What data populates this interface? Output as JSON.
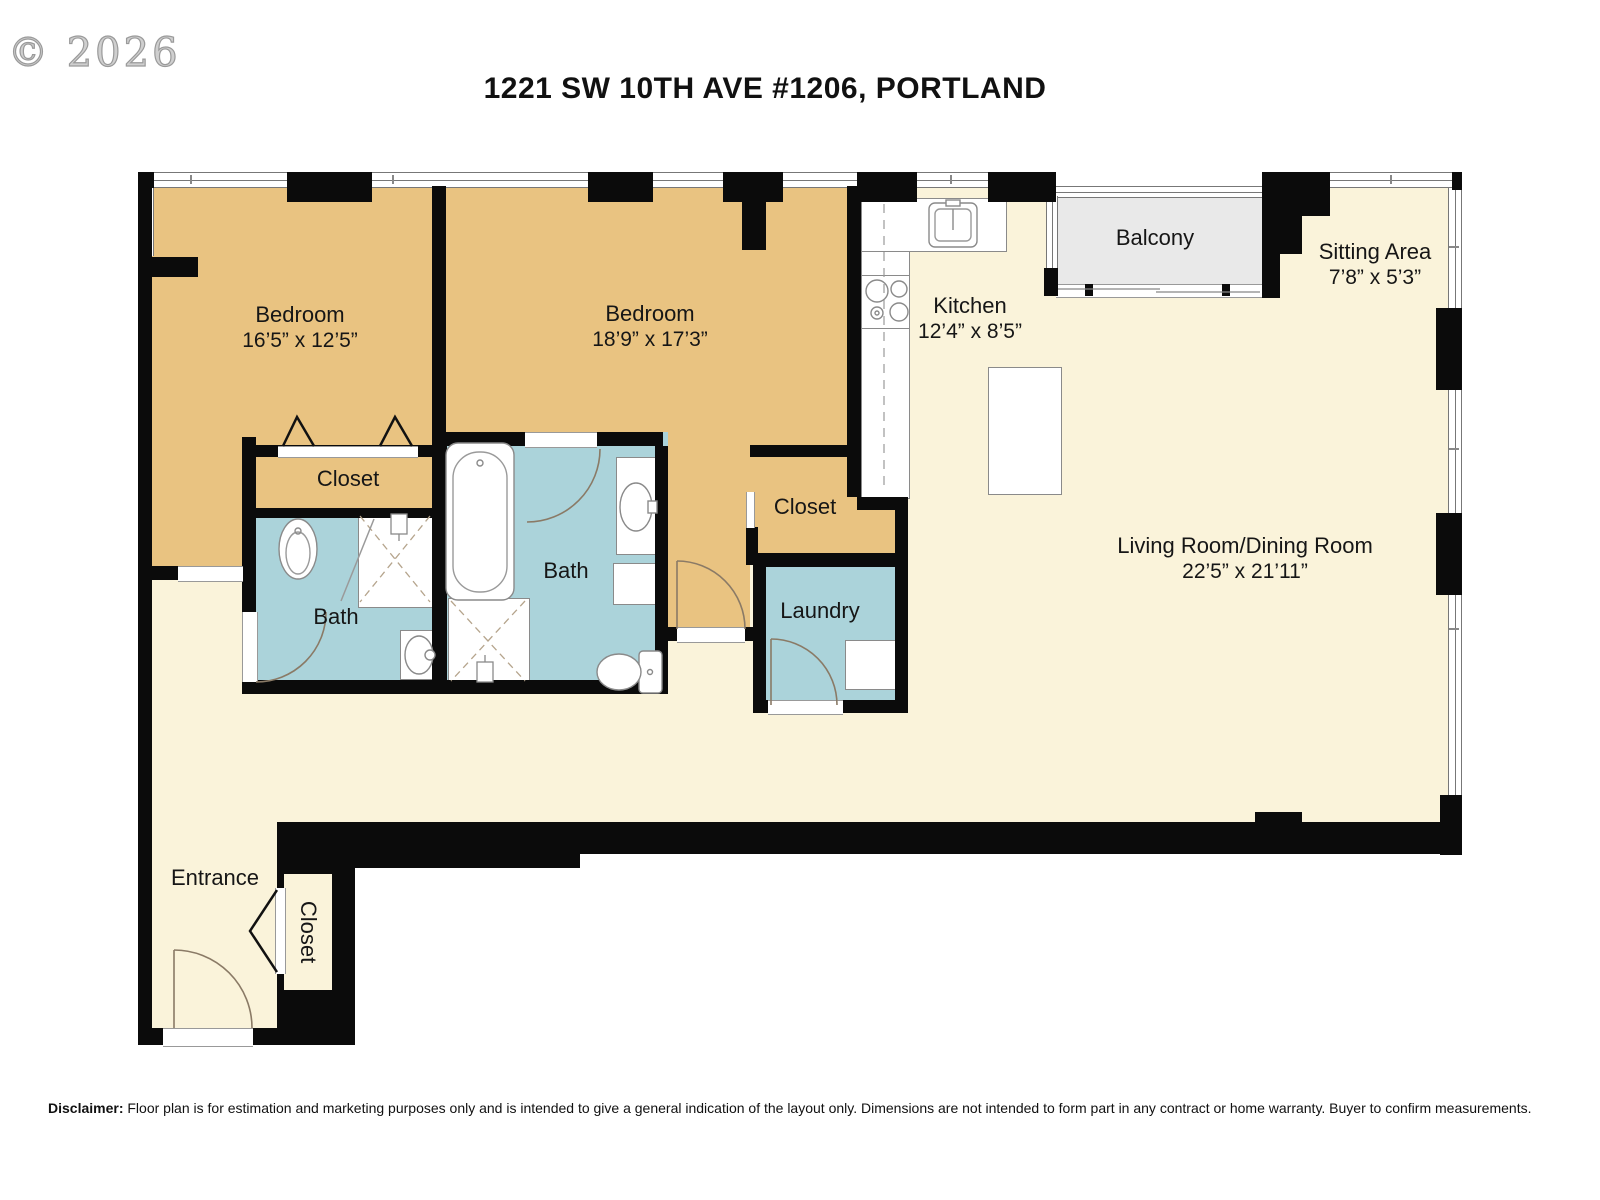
{
  "watermark": "© 2026",
  "title": "1221 SW 10TH AVE #1206, PORTLAND",
  "disclaimer": {
    "label": "Disclaimer:",
    "text": "Floor plan is for estimation and marketing purposes only and is intended to give a general indication of the layout only. Dimensions are not intended to form part in any contract or home warranty. Buyer to confirm measurements."
  },
  "rooms": {
    "bedroom1": {
      "name": "Bedroom",
      "dims": "16’5” x 12’5”"
    },
    "bedroom2": {
      "name": "Bedroom",
      "dims": "18’9” x 17’3”"
    },
    "kitchen": {
      "name": "Kitchen",
      "dims": "12’4” x 8’5”"
    },
    "balcony": {
      "name": "Balcony"
    },
    "sitting_area": {
      "name": "Sitting Area",
      "dims": "7’8” x 5’3”"
    },
    "living_dining": {
      "name": "Living Room/Dining Room",
      "dims": "22’5” x 21’11”"
    },
    "closet_bedroom1": {
      "name": "Closet"
    },
    "closet_bedroom2": {
      "name": "Closet"
    },
    "closet_entrance": {
      "name": "Closet"
    },
    "bath1": {
      "name": "Bath"
    },
    "bath2": {
      "name": "Bath"
    },
    "laundry": {
      "name": "Laundry"
    },
    "entrance": {
      "name": "Entrance"
    }
  },
  "fixtures": {
    "toilet1": "toilet",
    "toilet2": "toilet",
    "shower1": "shower",
    "shower2": "shower",
    "sink1": "sink",
    "sink2": "sink",
    "bathtub": "bathtub",
    "washer": "washer",
    "kitchen_sink": "kitchen-sink",
    "stove": "stove",
    "island": "kitchen-island"
  },
  "colors": {
    "bedroom_fill": "#e9c381",
    "bath_fill": "#abd3da",
    "floor_fill": "#faf3da",
    "balcony_fill": "#e9e9e9",
    "wall": "#0b0b0b"
  }
}
